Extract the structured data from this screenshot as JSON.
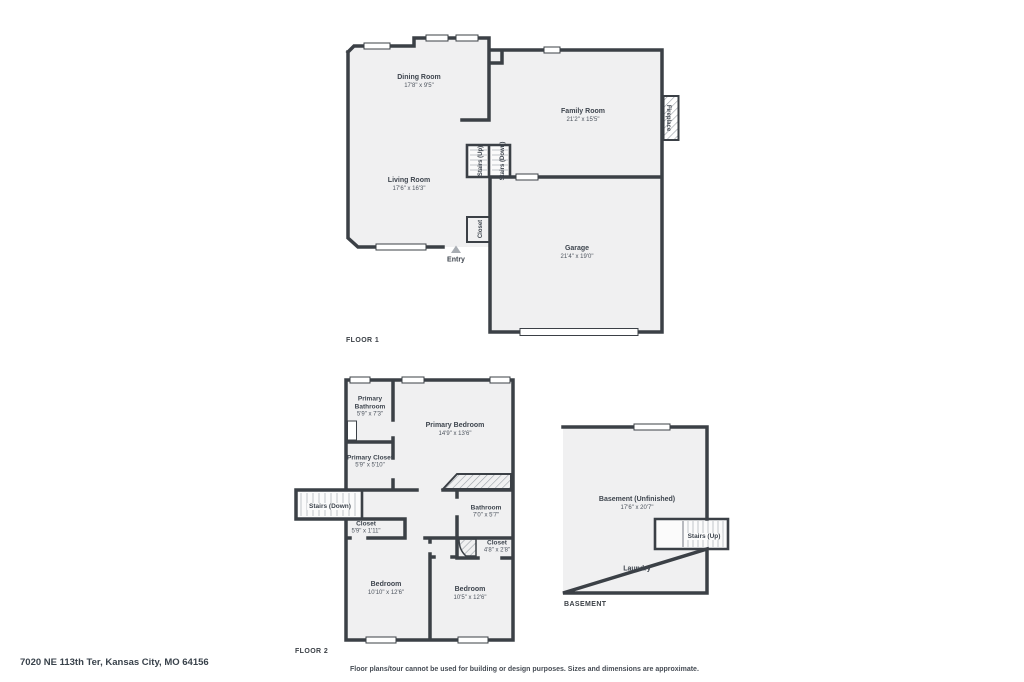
{
  "address": "7020 NE 113th Ter, Kansas City, MO 64156",
  "disclaimer": "Floor plans/tour cannot be used for building or design purposes. Sizes and dimensions are approximate.",
  "colors": {
    "wall": "#3b4046",
    "room_fill": "#f0f0f1",
    "text": "#3e454e",
    "hatch": "#9aa0a6",
    "entry_marker": "#a8adb3"
  },
  "floor1": {
    "label": "FLOOR 1",
    "rooms": [
      {
        "name": "Dining Room",
        "dims": "17'8\" x 9'5\""
      },
      {
        "name": "Family Room",
        "dims": "21'2\" x 15'5\""
      },
      {
        "name": "Living Room",
        "dims": "17'6\" x 16'3\""
      },
      {
        "name": "Garage",
        "dims": "21'4\" x 19'0\""
      }
    ],
    "features": {
      "stairs_up": "Stairs (Up)",
      "stairs_down": "Stairs (Down)",
      "closet": "Closet",
      "entry": "Entry",
      "fireplace": "Fireplace"
    }
  },
  "floor2": {
    "label": "FLOOR 2",
    "rooms": [
      {
        "name": "Primary Bathroom",
        "dims": "5'9\" x 7'3\""
      },
      {
        "name": "Primary Bedroom",
        "dims": "14'9\" x 13'6\""
      },
      {
        "name": "Primary Closet",
        "dims": "5'9\" x 5'10\""
      },
      {
        "name": "Closet",
        "dims": "5'9\" x 1'11\""
      },
      {
        "name": "Bathroom",
        "dims": "7'0\" x 5'7\""
      },
      {
        "name": "Closet",
        "dims": "4'8\" x 2'8\""
      },
      {
        "name": "Bedroom",
        "dims": "10'10\" x 12'6\""
      },
      {
        "name": "Bedroom",
        "dims": "10'5\" x 12'6\""
      }
    ],
    "features": {
      "stairs_down": "Stairs (Down)"
    }
  },
  "basement": {
    "label": "BASEMENT",
    "rooms": [
      {
        "name": "Basement (Unfinished)",
        "dims": "17'6\" x 20'7\""
      },
      {
        "name": "Laundry",
        "dims": ""
      }
    ],
    "features": {
      "stairs_up": "Stairs (Up)"
    }
  }
}
